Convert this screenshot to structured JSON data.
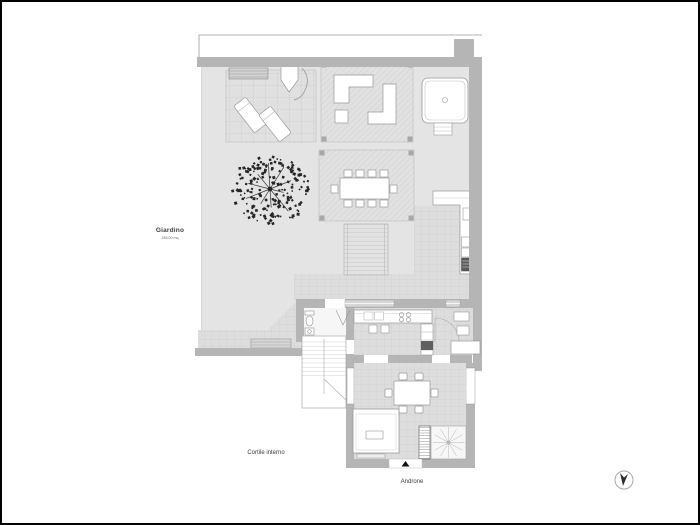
{
  "plan": {
    "title": "apartment-floor-plan",
    "labels": {
      "garden": "Giardino",
      "garden_area": "245.00 mq",
      "courtyard": "Cortile interno",
      "entrance_hall": "Androne"
    },
    "icons": {
      "compass": "north-arrow-icon",
      "entrance_marker": "entrance-triangle-icon"
    },
    "colors": {
      "background": "#ffffff",
      "wall": "#b5b5b5",
      "garden_fill": "#e4e4e4",
      "tile_fill": "#dddddd",
      "hatch_fill": "#e1e1e1",
      "furniture_fill": "#ffffff",
      "outline": "#999999",
      "tree": "#262626",
      "appliance_dark": "#5a5a5a"
    }
  }
}
